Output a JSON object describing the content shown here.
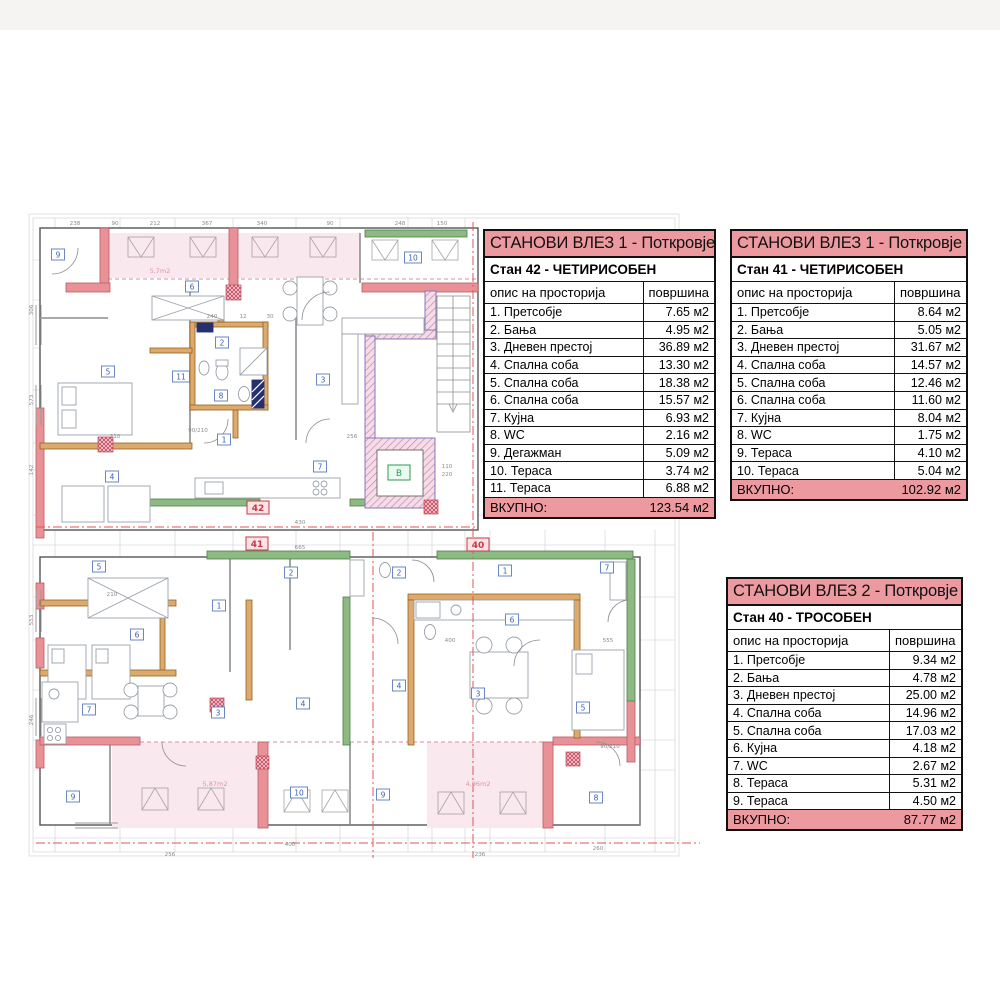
{
  "page": {
    "background": "#ffffff",
    "accent_pink": "#ec9aa0",
    "wall_pink": "#e89298",
    "wall_orange": "#ddaa6e",
    "wall_green": "#8cba82",
    "wall_purple": "#8677bd",
    "section_line_red": "#e05555"
  },
  "tables": [
    {
      "title": "СТАНОВИ ВЛЕЗ 1 - Поткровје",
      "subtitle": "Стан 42 - ЧЕТИРИСОБЕН",
      "col_desc": "опис на просторија",
      "col_area": "површина",
      "rows": [
        [
          "1. Претсобје",
          "7.65 м2"
        ],
        [
          "2. Бања",
          "4.95 м2"
        ],
        [
          "3. Дневен престој",
          "36.89 м2"
        ],
        [
          "4. Спална соба",
          "13.30 м2"
        ],
        [
          "5. Спална соба",
          "18.38 м2"
        ],
        [
          "6. Спална соба",
          "15.57 м2"
        ],
        [
          "7. Кујна",
          "6.93 м2"
        ],
        [
          "8. WC",
          "2.16 м2"
        ],
        [
          "9. Дегажман",
          "5.09 м2"
        ],
        [
          "10. Тераса",
          "3.74 м2"
        ],
        [
          "11. Тераса",
          "6.88 м2"
        ]
      ],
      "total_label": "ВКУПНО:",
      "total_value": "123.54 м2"
    },
    {
      "title": "СТАНОВИ ВЛЕЗ 1 - Поткровје",
      "subtitle": "Стан 41 - ЧЕТИРИСОБЕН",
      "col_desc": "опис на просторија",
      "col_area": "површина",
      "rows": [
        [
          "1. Претсобје",
          "8.64 м2"
        ],
        [
          "2. Бања",
          "5.05 м2"
        ],
        [
          "3. Дневен престој",
          "31.67 м2"
        ],
        [
          "4. Спална соба",
          "14.57 м2"
        ],
        [
          "5. Спална соба",
          "12.46 м2"
        ],
        [
          "6. Спална соба",
          "11.60 м2"
        ],
        [
          "7. Кујна",
          "8.04 м2"
        ],
        [
          "8. WC",
          "1.75 м2"
        ],
        [
          "9. Тераса",
          "4.10 м2"
        ],
        [
          "10. Тераса",
          "5.04 м2"
        ]
      ],
      "total_label": "ВКУПНО:",
      "total_value": "102.92 м2"
    },
    {
      "title": "СТАНОВИ ВЛЕЗ 2 - Поткровје",
      "subtitle": "Стан 40 - ТРОСОБЕН",
      "col_desc": "опис на просторија",
      "col_area": "површина",
      "rows": [
        [
          "1. Претсобје",
          "9.34 м2"
        ],
        [
          "2. Бања",
          "4.78 м2"
        ],
        [
          "3. Дневен престој",
          "25.00 м2"
        ],
        [
          "4. Спална соба",
          "14.96 м2"
        ],
        [
          "5. Спална соба",
          "17.03 м2"
        ],
        [
          "6. Кујна",
          "4.18 м2"
        ],
        [
          "7. WC",
          "2.67 м2"
        ],
        [
          "8. Тераса",
          "5.31 м2"
        ],
        [
          "9. Тераса",
          "4.50 м2"
        ]
      ],
      "total_label": "ВКУПНО:",
      "total_value": "87.77 м2"
    }
  ],
  "plan": {
    "elevator_label": "B",
    "apartment_labels": [
      {
        "text": "42",
        "x": 258,
        "y": 508
      },
      {
        "text": "41",
        "x": 257,
        "y": 544
      },
      {
        "text": "40",
        "x": 478,
        "y": 545
      }
    ],
    "room_labels": [
      {
        "n": "9",
        "x": 58,
        "y": 255
      },
      {
        "n": "6",
        "x": 192,
        "y": 287
      },
      {
        "n": "10",
        "x": 413,
        "y": 258
      },
      {
        "n": "5",
        "x": 108,
        "y": 372
      },
      {
        "n": "2",
        "x": 222,
        "y": 343
      },
      {
        "n": "11",
        "x": 181,
        "y": 377
      },
      {
        "n": "8",
        "x": 221,
        "y": 396
      },
      {
        "n": "1",
        "x": 224,
        "y": 440
      },
      {
        "n": "3",
        "x": 323,
        "y": 380
      },
      {
        "n": "7",
        "x": 320,
        "y": 467
      },
      {
        "n": "4",
        "x": 112,
        "y": 477
      },
      {
        "n": "5",
        "x": 99,
        "y": 567
      },
      {
        "n": "2",
        "x": 291,
        "y": 573
      },
      {
        "n": "1",
        "x": 219,
        "y": 606
      },
      {
        "n": "6",
        "x": 137,
        "y": 635
      },
      {
        "n": "7",
        "x": 89,
        "y": 710
      },
      {
        "n": "3",
        "x": 218,
        "y": 713
      },
      {
        "n": "4",
        "x": 303,
        "y": 704
      },
      {
        "n": "9",
        "x": 73,
        "y": 797
      },
      {
        "n": "10",
        "x": 299,
        "y": 793
      },
      {
        "n": "2",
        "x": 399,
        "y": 573
      },
      {
        "n": "1",
        "x": 505,
        "y": 571
      },
      {
        "n": "7",
        "x": 607,
        "y": 568
      },
      {
        "n": "6",
        "x": 512,
        "y": 620
      },
      {
        "n": "4",
        "x": 399,
        "y": 686
      },
      {
        "n": "3",
        "x": 478,
        "y": 694
      },
      {
        "n": "5",
        "x": 583,
        "y": 708
      },
      {
        "n": "9",
        "x": 383,
        "y": 795
      },
      {
        "n": "8",
        "x": 596,
        "y": 798
      }
    ],
    "terrace_labels": [
      {
        "text": "5,7m2",
        "x": 160,
        "y": 273
      },
      {
        "text": "5,87m2",
        "x": 215,
        "y": 786
      },
      {
        "text": "4,96m2",
        "x": 478,
        "y": 786
      }
    ],
    "dim_numbers": [
      {
        "t": "238",
        "x": 75,
        "y": 225
      },
      {
        "t": "90",
        "x": 115,
        "y": 225
      },
      {
        "t": "212",
        "x": 155,
        "y": 225
      },
      {
        "t": "367",
        "x": 207,
        "y": 225
      },
      {
        "t": "340",
        "x": 262,
        "y": 225
      },
      {
        "t": "90",
        "x": 330,
        "y": 225
      },
      {
        "t": "248",
        "x": 400,
        "y": 225
      },
      {
        "t": "150",
        "x": 442,
        "y": 225
      },
      {
        "t": "306",
        "x": 33,
        "y": 310,
        "r": 1
      },
      {
        "t": "573",
        "x": 33,
        "y": 400,
        "r": 1
      },
      {
        "t": "142",
        "x": 33,
        "y": 470,
        "r": 1
      },
      {
        "t": "553",
        "x": 33,
        "y": 620,
        "r": 1
      },
      {
        "t": "246",
        "x": 33,
        "y": 720,
        "r": 1
      },
      {
        "t": "240",
        "x": 212,
        "y": 318
      },
      {
        "t": "12",
        "x": 243,
        "y": 318
      },
      {
        "t": "30",
        "x": 270,
        "y": 318
      },
      {
        "t": "210",
        "x": 115,
        "y": 438
      },
      {
        "t": "256",
        "x": 352,
        "y": 438
      },
      {
        "t": "430",
        "x": 300,
        "y": 524
      },
      {
        "t": "110",
        "x": 447,
        "y": 468
      },
      {
        "t": "220",
        "x": 447,
        "y": 476
      },
      {
        "t": "90/210",
        "x": 198,
        "y": 432
      },
      {
        "t": "90/210",
        "x": 610,
        "y": 748
      },
      {
        "t": "665",
        "x": 300,
        "y": 549
      },
      {
        "t": "210",
        "x": 112,
        "y": 596
      },
      {
        "t": "400",
        "x": 450,
        "y": 642
      },
      {
        "t": "555",
        "x": 608,
        "y": 642
      },
      {
        "t": "400",
        "x": 290,
        "y": 846
      },
      {
        "t": "256",
        "x": 170,
        "y": 856
      },
      {
        "t": "236",
        "x": 480,
        "y": 856
      },
      {
        "t": "260",
        "x": 598,
        "y": 850
      }
    ]
  }
}
